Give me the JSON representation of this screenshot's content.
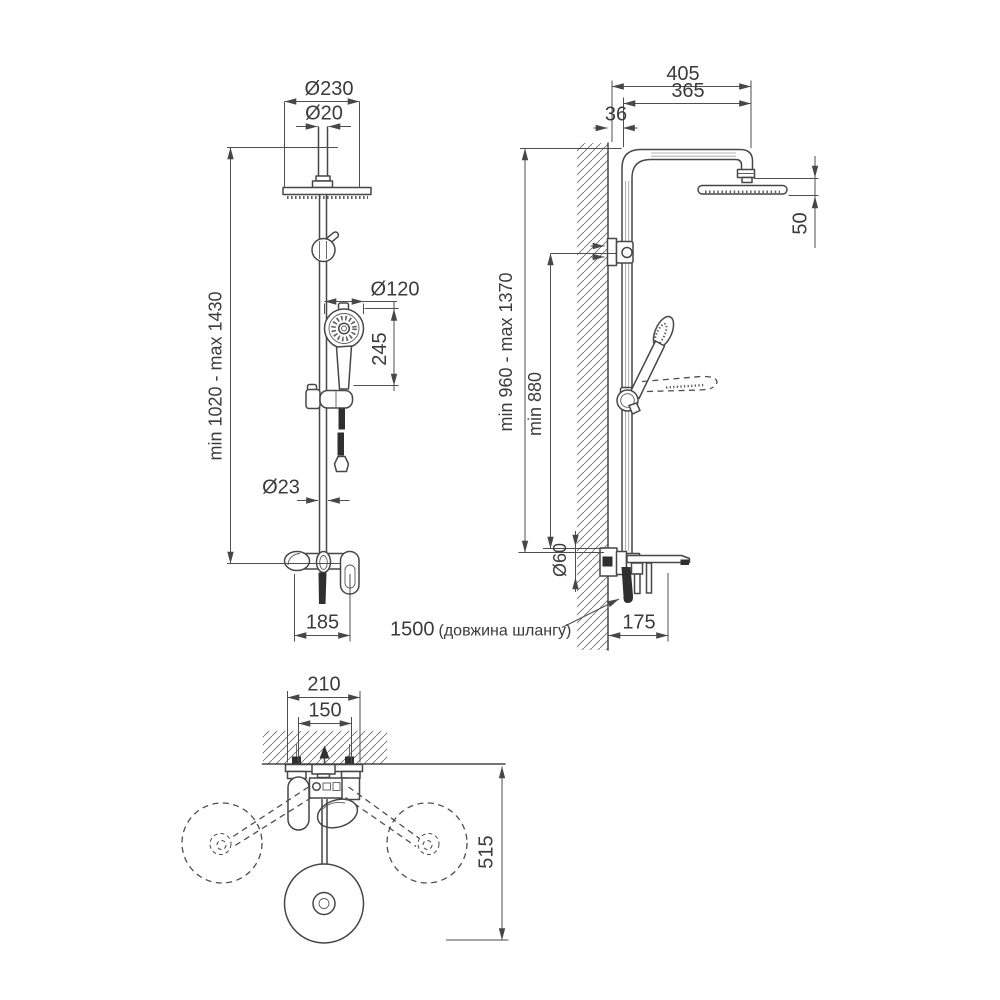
{
  "meta": {
    "background": "#ffffff",
    "line_color": "#474747",
    "dimension_color": "#4e4e4e",
    "text_color": "#3b3b3b",
    "hatch_color": "#707070"
  },
  "front_view": {
    "head_diameter": "Ø230",
    "pipe_top_diameter": "Ø20",
    "height_range": "min 1020 - max 1430",
    "handshower_diameter": "Ø120",
    "handshower_length": "245",
    "column_diameter": "Ø23",
    "mixer_width": "185"
  },
  "side_view": {
    "arm_overall": "405",
    "arm_reach": "365",
    "wall_offset": "36",
    "head_height": "50",
    "column_range": "min 960 - max 1370",
    "bracket_min_height": "min 880",
    "supply_diameter": "Ø60",
    "spout_reach": "175",
    "hose_value": "1500",
    "hose_note": "(довжина шлангу)"
  },
  "top_view": {
    "plate_width": "210",
    "holes_spacing": "150",
    "swing_radius": "515"
  }
}
